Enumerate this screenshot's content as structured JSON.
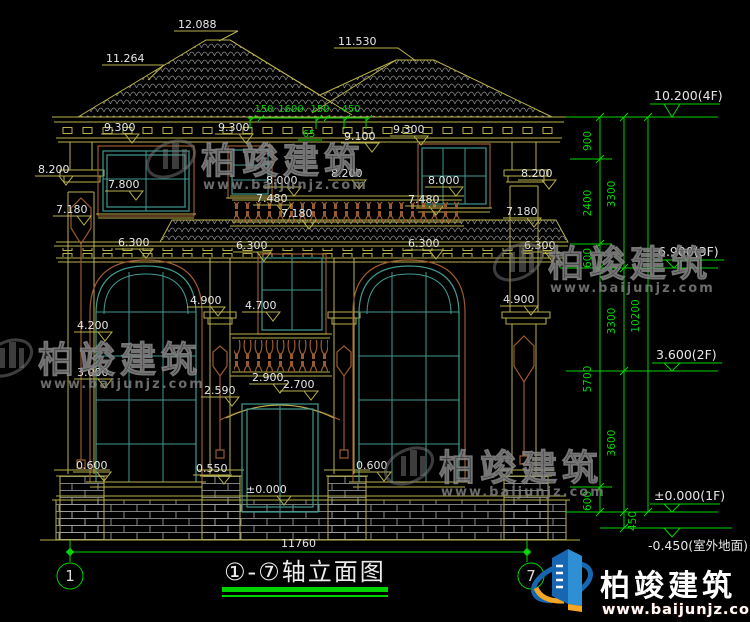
{
  "drawing": {
    "title": "①-⑦轴立面图",
    "axis_left": "1",
    "axis_right": "7",
    "bottom_width_dim": "11760"
  },
  "roof_labels": {
    "ridge": "12.088",
    "left_slope": "11.264",
    "right_ridge": "11.530"
  },
  "top_dims": {
    "d1": "150",
    "d2": "1600",
    "d3": "150",
    "d4": "450",
    "d5": "65"
  },
  "face_labels": {
    "eave_left": "9.300",
    "eave_mid": "9.300",
    "eave_right": "9.300",
    "eave_low": "9.100",
    "cap_left": "8.200",
    "cap_mid": "8.200",
    "cap_right": "8.200",
    "sill3f_left": "7.800",
    "sill3f_mid": "8.000",
    "sill3f_right": "8.000",
    "rail3f_left": "7.480",
    "rail3f_right": "7.480",
    "railbtm_left": "7.180",
    "railbtm_mid": "7.180",
    "railbtm_right": "7.180",
    "band_left": "6.300",
    "band_mid": "6.300",
    "band_right": "6.300",
    "band_far_right": "6.300",
    "cap2f_left": "4.900",
    "cap2f_right": "4.900",
    "sill2f_mid": "4.700",
    "arch_left_upper": "4.200",
    "arch_left_lower": "3.000",
    "door_top": "2.900",
    "door_arch": "2.700",
    "door_spring": "2.590",
    "sill1f_left": "0.600",
    "sill1f_door": "0.550",
    "sill1f_right": "0.600",
    "floor_zero": "±0.000"
  },
  "right_dims": {
    "chain": [
      "900",
      "2400",
      "600",
      "5700",
      "600"
    ],
    "floors": [
      "3300",
      "3300",
      "3600",
      "450"
    ],
    "total": "10200"
  },
  "levels": {
    "l4f": "10.200(4F)",
    "l3f": "6.900(3F)",
    "l2f": "3.600(2F)",
    "l1f": "±0.000(1F)",
    "lg": "-0.450(室外地面)"
  },
  "watermark": {
    "name": "柏竣建筑",
    "url": "www.baijunjz.com"
  },
  "logo": {
    "name": "柏竣建筑",
    "url": "www.baijunjz.com"
  },
  "colors": {
    "cad_yellow": "#b9b24b",
    "dim_green": "#00d400",
    "window_teal": "#3f9a90",
    "ornament_brown": "#9a5a2e",
    "text_white": "#e6e6e6",
    "watermark_gray": "#7a7a7a",
    "logo_blue": "#1766b2",
    "logo_orange": "#f5a623",
    "background": "#000000"
  }
}
